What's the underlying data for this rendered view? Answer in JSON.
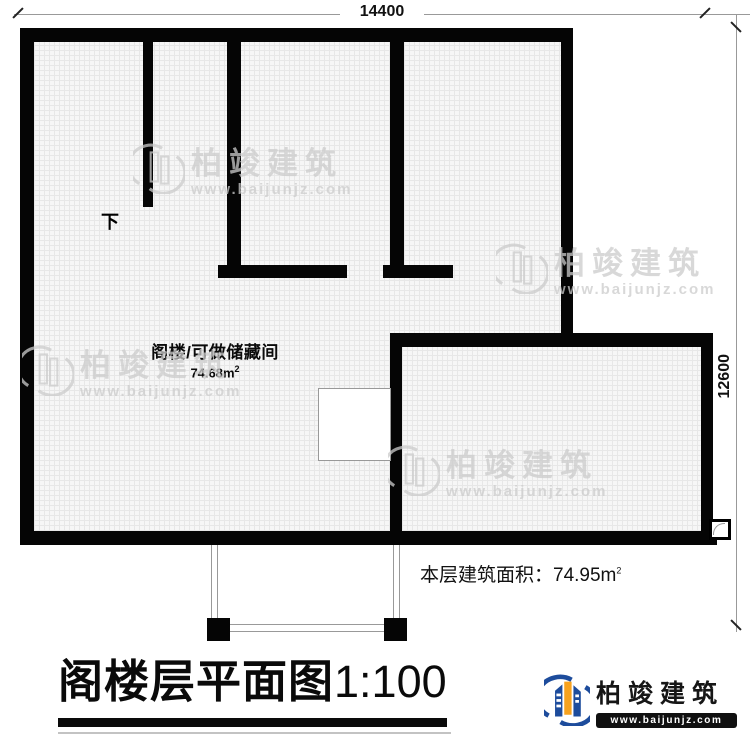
{
  "dimensions": {
    "top": "14400",
    "right": "12600"
  },
  "stair": {
    "down_label": "下"
  },
  "room": {
    "name": "阁楼/可做储藏间",
    "area_value": "74.68m",
    "area_sup": "2"
  },
  "floor_area": {
    "label": "本层建筑面积：",
    "value": "74.95m",
    "sup": "2"
  },
  "title": {
    "text": "阁楼层平面图",
    "scale": "1:100"
  },
  "logo": {
    "company": "柏竣建筑",
    "website": "www.baijunjz.com"
  },
  "watermark": {
    "company": "柏竣建筑",
    "website": "www.baijunjz.com"
  },
  "colors": {
    "wall": "#050505",
    "floor_hatch_bg": "#f6f6f6",
    "floor_hatch_line": "#e7e7e7",
    "stair_bg": "#e3e7db",
    "watermark_gray": "#cccccc",
    "logo_blue": "#1d4c9c",
    "logo_orange": "#f7a21e"
  }
}
